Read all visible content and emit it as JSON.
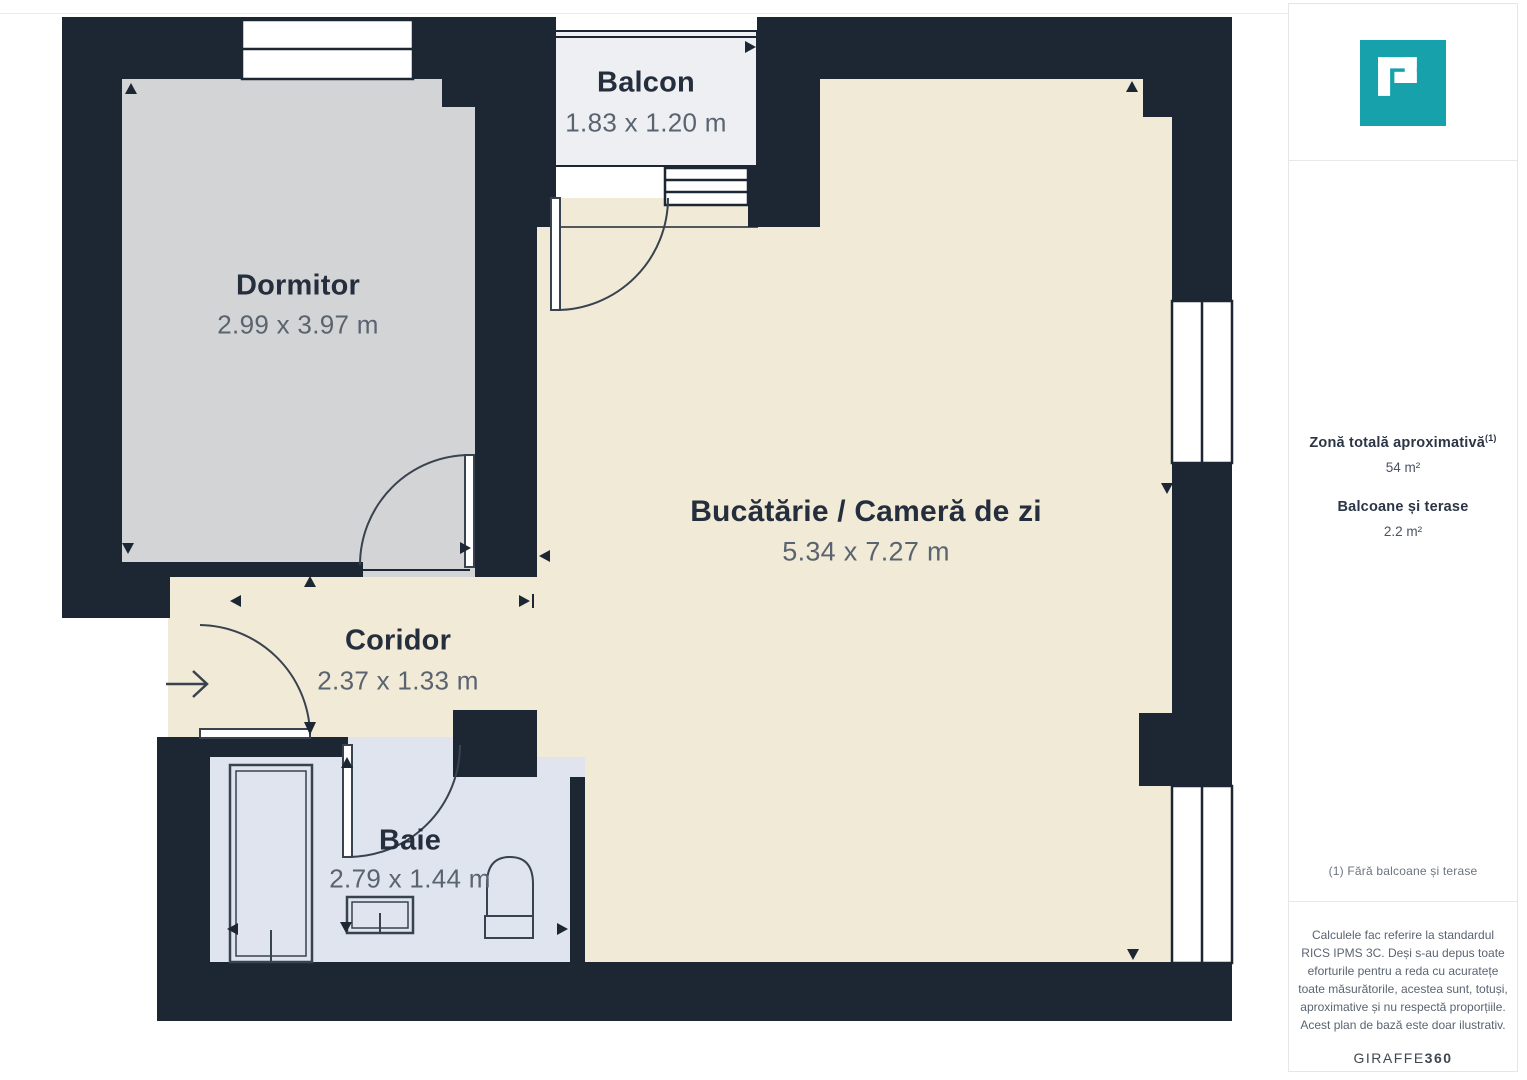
{
  "floorplan": {
    "rooms": [
      {
        "name": "Dormitor",
        "dimensions": "2.99 x 3.97 m"
      },
      {
        "name": "Balcon",
        "dimensions": "1.83 x 1.20 m"
      },
      {
        "name": "Bucătărie / Cameră de zi",
        "dimensions": "5.34 x 7.27 m"
      },
      {
        "name": "Coridor",
        "dimensions": "2.37 x 1.33 m"
      },
      {
        "name": "Baie",
        "dimensions": "2.79 x 1.44 m"
      }
    ],
    "colors": {
      "wall": "#1c2733",
      "floor_living": "#f1ead6",
      "floor_bedroom": "#d3d4d6",
      "floor_balcony": "#edeff2",
      "floor_bathroom": "#dfe4ef",
      "line": "#39424f",
      "brand_teal": "#17a2ab"
    }
  },
  "sidebar": {
    "total_area": {
      "label": "Zonă totală aproximativă",
      "footnote_ref": "(1)",
      "value": "54 m²"
    },
    "balconies": {
      "label": "Balcoane și terase",
      "value": "2.2 m²"
    },
    "footnote": "(1) Fără balcoane și terase",
    "disclaimer": "Calculele fac referire la standardul RICS IPMS 3C. Deși s-au depus toate eforturile pentru a reda cu acuratețe toate măsurătorile, acestea sunt, totuși, aproximative și nu respectă proporțiile. Acest plan de bază este doar ilustrativ.",
    "brand": {
      "name": "GIRAFFE",
      "suffix": "360"
    }
  }
}
